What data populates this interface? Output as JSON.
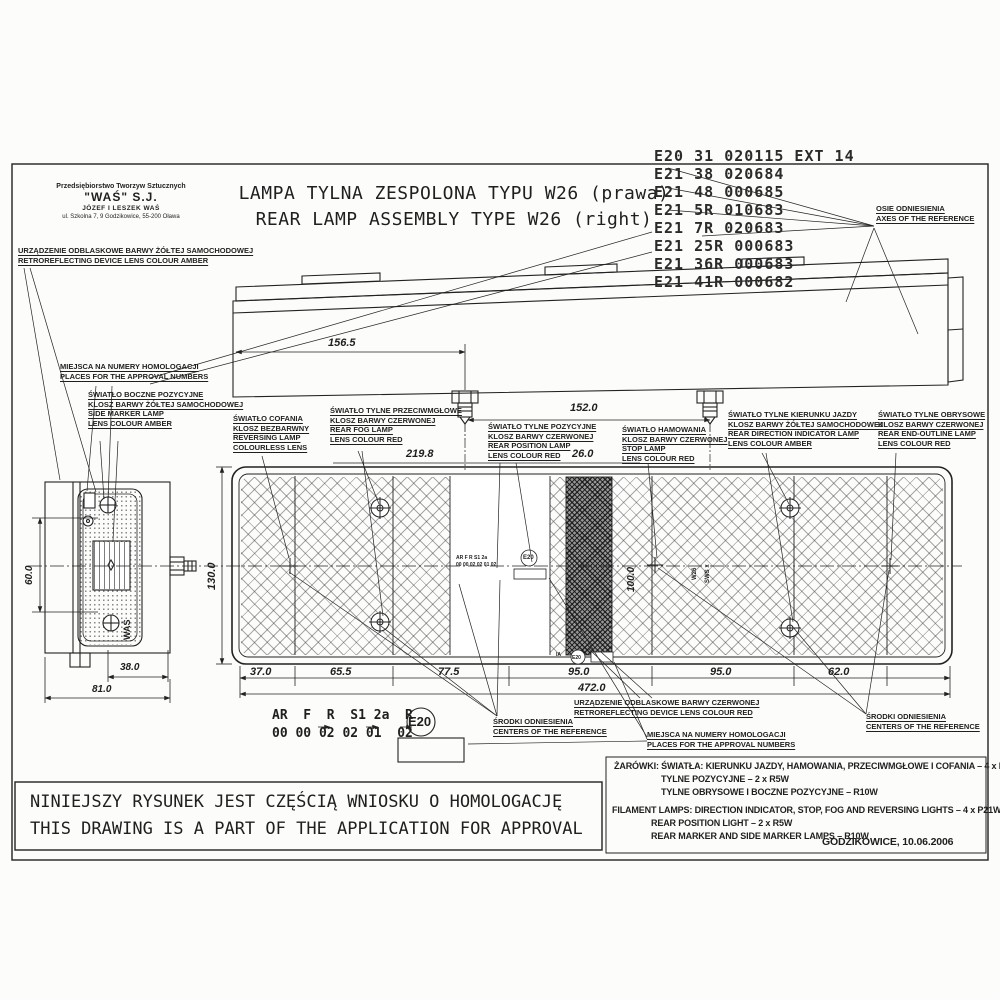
{
  "colors": {
    "paper": "#fcfcfb",
    "ink": "#1f1f1f",
    "hatch": "#555555"
  },
  "company": {
    "lines": [
      "Przedsiębiorstwo Tworzyw Sztucznych",
      "\"WAŚ\" S.J.",
      "JÓZEF I LESZEK WAŚ",
      "ul. Szkolna 7, 9 Godzikowice, 55-200 Oława"
    ]
  },
  "title": {
    "pl": "LAMPA TYLNA ZESPOLONA TYPU W26 (prawa)",
    "en": "REAR LAMP ASSEMBLY TYPE W26 (right)"
  },
  "stamps": {
    "rows": [
      "E20 31  020115 EXT 14",
      "E21 38  020684",
      "E21 48  000685",
      "E21 5R  010683",
      "E21 7R  020683",
      "E21 25R 000683",
      "E21 36R 000683",
      "E21 41R 000682"
    ]
  },
  "labels": {
    "axes_ref": [
      "OSIE ODNIESIENIA",
      "AXES OF THE REFERENCE"
    ],
    "amber_reflector": [
      "URZĄDZENIE ODBLASKOWE BARWY ŻÓŁTEJ SAMOCHODOWEJ",
      "RETROREFLECTING DEVICE LENS COLOUR AMBER"
    ],
    "approval_places": [
      "MIEJSCA NA NUMERY HOMOLOGACJI",
      "PLACES FOR THE APPROVAL NUMBERS"
    ],
    "side_marker": [
      "ŚWIATŁO BOCZNE POZYCYJNE",
      "KLOSZ BARWY ŻÓŁTEJ SAMOCHODOWEJ",
      "SIDE MARKER LAMP",
      "LENS COLOUR AMBER"
    ],
    "reversing": [
      "ŚWIATŁO COFANIA",
      "KLOSZ BEZBARWNY",
      "REVERSING LAMP",
      "COLOURLESS LENS"
    ],
    "fog": [
      "ŚWIATŁO TYLNE PRZECIWMGŁOWE",
      "KLOSZ BARWY CZERWONEJ",
      "REAR FOG LAMP",
      "LENS COLOUR RED"
    ],
    "position": [
      "ŚWIATŁO TYLNE POZYCYJNE",
      "KLOSZ BARWY CZERWONEJ",
      "REAR POSITION LAMP",
      "LENS COLOUR RED"
    ],
    "stop": [
      "ŚWIATŁO HAMOWANIA",
      "KLOSZ BARWY CZERWONEJ",
      "STOP LAMP",
      "LENS COLOUR RED"
    ],
    "indicator": [
      "ŚWIATŁO TYLNE KIERUNKU JAZDY",
      "KLOSZ BARWY ŻÓŁTEJ SAMOCHODOWEJ",
      "REAR DIRECTION INDICATOR LAMP",
      "LENS COLOUR AMBER"
    ],
    "outline": [
      "ŚWIATŁO TYLNE OBRYSOWE",
      "KLOSZ BARWY CZERWONEJ",
      "REAR END-OUTLINE LAMP",
      "LENS COLOUR RED"
    ],
    "red_reflector": [
      "URZĄDZENIE ODBLASKOWE BARWY CZERWONEJ",
      "RETROREFLECTING DEVICE LENS COLOUR RED"
    ],
    "centers": [
      "ŚRODKI ODNIESIENIA",
      "CENTERS OF THE REFERENCE"
    ]
  },
  "dims": {
    "top_left": "156.5",
    "stud_spacing": "152.0",
    "fog_width": "219.8",
    "position_width": "26.0",
    "height": "130.0",
    "inner_height": "100.0",
    "segments": [
      "37.0",
      "65.5",
      "77.5",
      "95.0",
      "95.0",
      "62.0"
    ],
    "total": "472.0",
    "side_depth": "38.0",
    "side_width": "81.0",
    "side_height": "60.0"
  },
  "markings": {
    "codes": "AR  F  R  S1 2a  R",
    "values": "00 00 02 02 01  02",
    "e_mark": "E20",
    "inner_codes": "AR F R S1 2a",
    "inner_values": "00 00 02 02 01 02",
    "inner_e": "E20",
    "ia": "IA",
    "ia_e": "E20",
    "molded_1": "W26",
    "molded_2": "SWS x",
    "brand_vertical": "WAŚ"
  },
  "notes": {
    "pl": [
      "ŻARÓWKI: ŚWIATŁA: KIERUNKU JAZDY, HAMOWANIA, PRZECIWMGŁOWE I COFANIA – 4 x P21W",
      "TYLNE POZYCYJNE – 2 x R5W",
      "TYLNE OBRYSOWE I BOCZNE POZYCYJNE – R10W"
    ],
    "en": [
      "FILAMENT LAMPS: DIRECTION INDICATOR, STOP,  FOG AND REVERSING LIGHTS – 4 x P21W",
      "REAR POSITION LIGHT –  2 x R5W",
      "REAR MARKER AND SIDE MARKER LAMPS – R10W"
    ],
    "place_date": "GODZIKOWICE, 10.06.2006"
  },
  "statement": {
    "pl": "NINIEJSZY RYSUNEK JEST CZĘŚCIĄ WNIOSKU O HOMOLOGACJĘ",
    "en": "THIS DRAWING IS A PART OF THE APPLICATION FOR APPROVAL"
  }
}
